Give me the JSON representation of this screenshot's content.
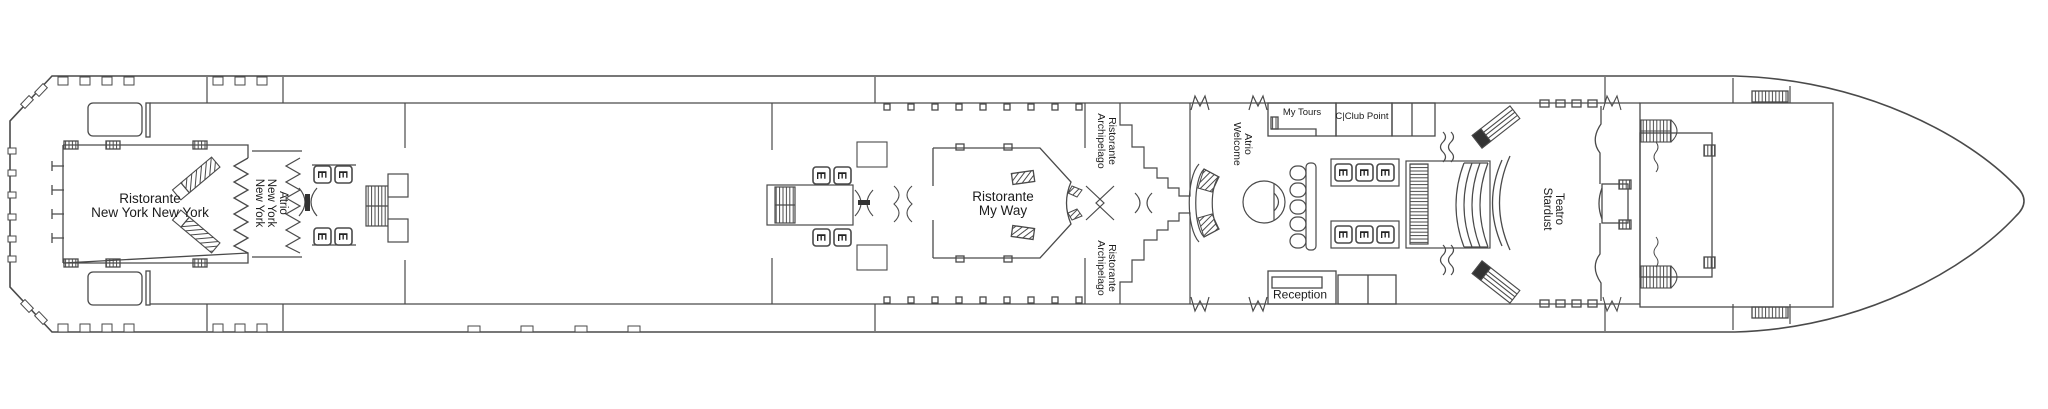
{
  "deck_plan": {
    "background": "#ffffff",
    "line_color": "#4a4a4a",
    "text_color": "#1c1c1c",
    "venues": {
      "ristorante_new_york": {
        "line1": "Ristorante",
        "line2": "New York New York"
      },
      "atrio_new_york": {
        "line1": "Atrio",
        "line2": "New York",
        "line3": "New York"
      },
      "ristorante_my_way": {
        "line1": "Ristorante",
        "line2": "My Way"
      },
      "ristorante_archipelago_upper": {
        "line1": "Ristorante",
        "line2": "Archipelago"
      },
      "ristorante_archipelago_lower": {
        "line1": "Ristorante",
        "line2": "Archipelago"
      },
      "atrio_welcome": {
        "line1": "Atrio",
        "line2": "Welcome"
      },
      "my_tours": {
        "label": "My Tours"
      },
      "c_club_point": {
        "label": "C|Club Point"
      },
      "reception": {
        "label": "Reception"
      },
      "teatro_stardust": {
        "line1": "Teatro",
        "line2": "Stardust"
      }
    },
    "icons": {
      "elevator": "E"
    }
  }
}
